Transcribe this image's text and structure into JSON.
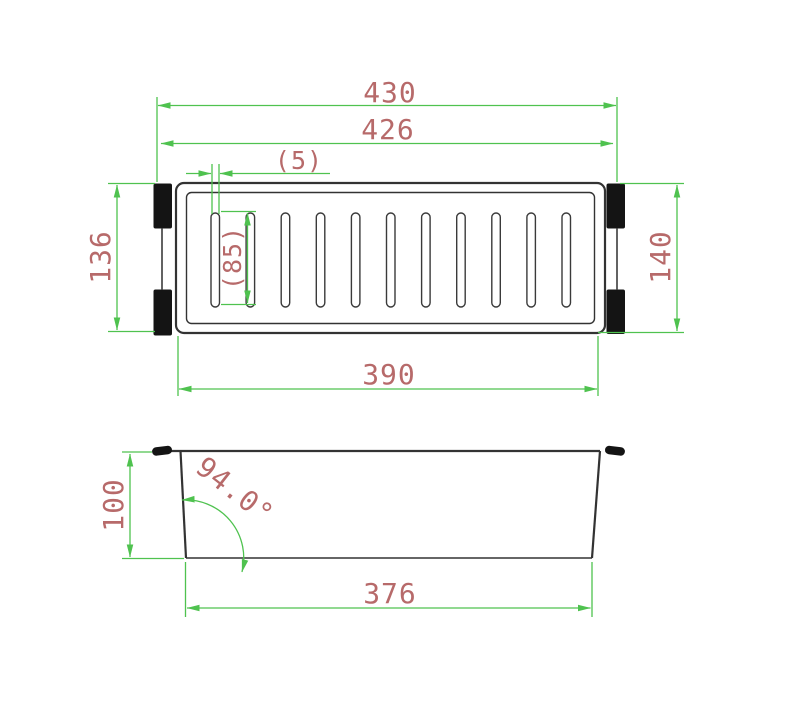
{
  "colors": {
    "dimension_green": "#4fc24f",
    "label_red": "#b76a6a",
    "outline_dark": "#333333",
    "handle_black": "#141414"
  },
  "top_view": {
    "label_overall_width": "430",
    "label_rim_width": "426",
    "label_slot_width": "(5)",
    "label_slot_length": "(85)",
    "label_left_height": "136",
    "label_right_height": "140",
    "label_inner_width": "390",
    "slot_count": 11
  },
  "side_view": {
    "label_height": "100",
    "label_wall_angle": "94.0°",
    "label_base_width": "376"
  }
}
